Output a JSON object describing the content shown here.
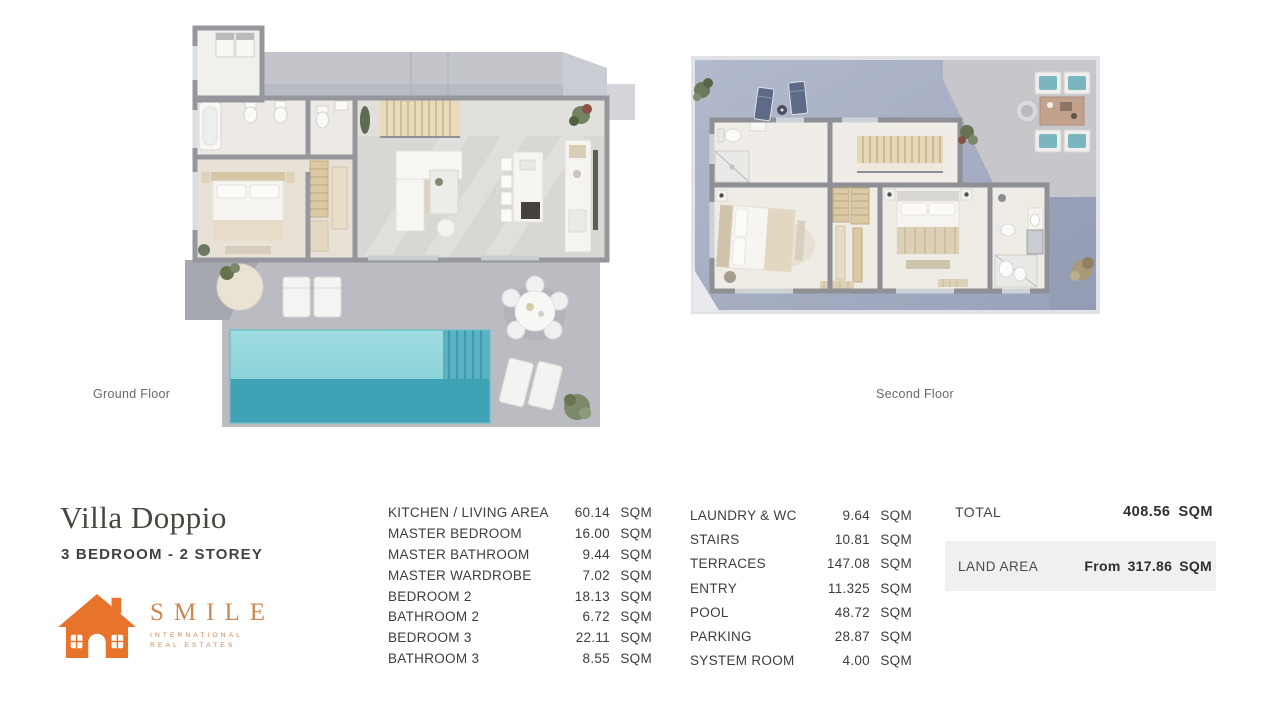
{
  "plans": {
    "ground": {
      "label": "Ground Floor"
    },
    "second": {
      "label": "Second Floor"
    }
  },
  "title_block": {
    "title": "Villa Doppio",
    "subtitle": "3 BEDROOM - 2 STOREY",
    "logo": {
      "brand": "SMILE",
      "tagline_line1": "INTERNATIONAL",
      "tagline_line2": "REAL ESTATES",
      "brand_color": "#cd8750",
      "house_color": "#e8732b"
    }
  },
  "area_table": {
    "unit": "SQM",
    "column1": [
      {
        "label": "KITCHEN / LIVING AREA",
        "value": "60.14"
      },
      {
        "label": "MASTER BEDROOM",
        "value": "16.00"
      },
      {
        "label": "MASTER BATHROOM",
        "value": "9.44"
      },
      {
        "label": "MASTER WARDROBE",
        "value": "7.02"
      },
      {
        "label": "BEDROOM 2",
        "value": "18.13"
      },
      {
        "label": "BATHROOM 2",
        "value": "6.72"
      },
      {
        "label": "BEDROOM 3",
        "value": "22.11"
      },
      {
        "label": "BATHROOM 3",
        "value": "8.55"
      }
    ],
    "column2": [
      {
        "label": "LAUNDRY & WC",
        "value": "9.64"
      },
      {
        "label": "STAIRS",
        "value": "10.81"
      },
      {
        "label": "TERRACES",
        "value": "147.08"
      },
      {
        "label": "ENTRY",
        "value": "11.325"
      },
      {
        "label": "POOL",
        "value": "48.72"
      },
      {
        "label": "PARKING",
        "value": "28.87"
      },
      {
        "label": "SYSTEM ROOM",
        "value": "4.00"
      }
    ],
    "total": {
      "label": "TOTAL",
      "value": "408.56",
      "unit": "SQM"
    },
    "land_area": {
      "label": "LAND AREA",
      "prefix": "From",
      "value": "317.86",
      "unit": "SQM"
    }
  }
}
